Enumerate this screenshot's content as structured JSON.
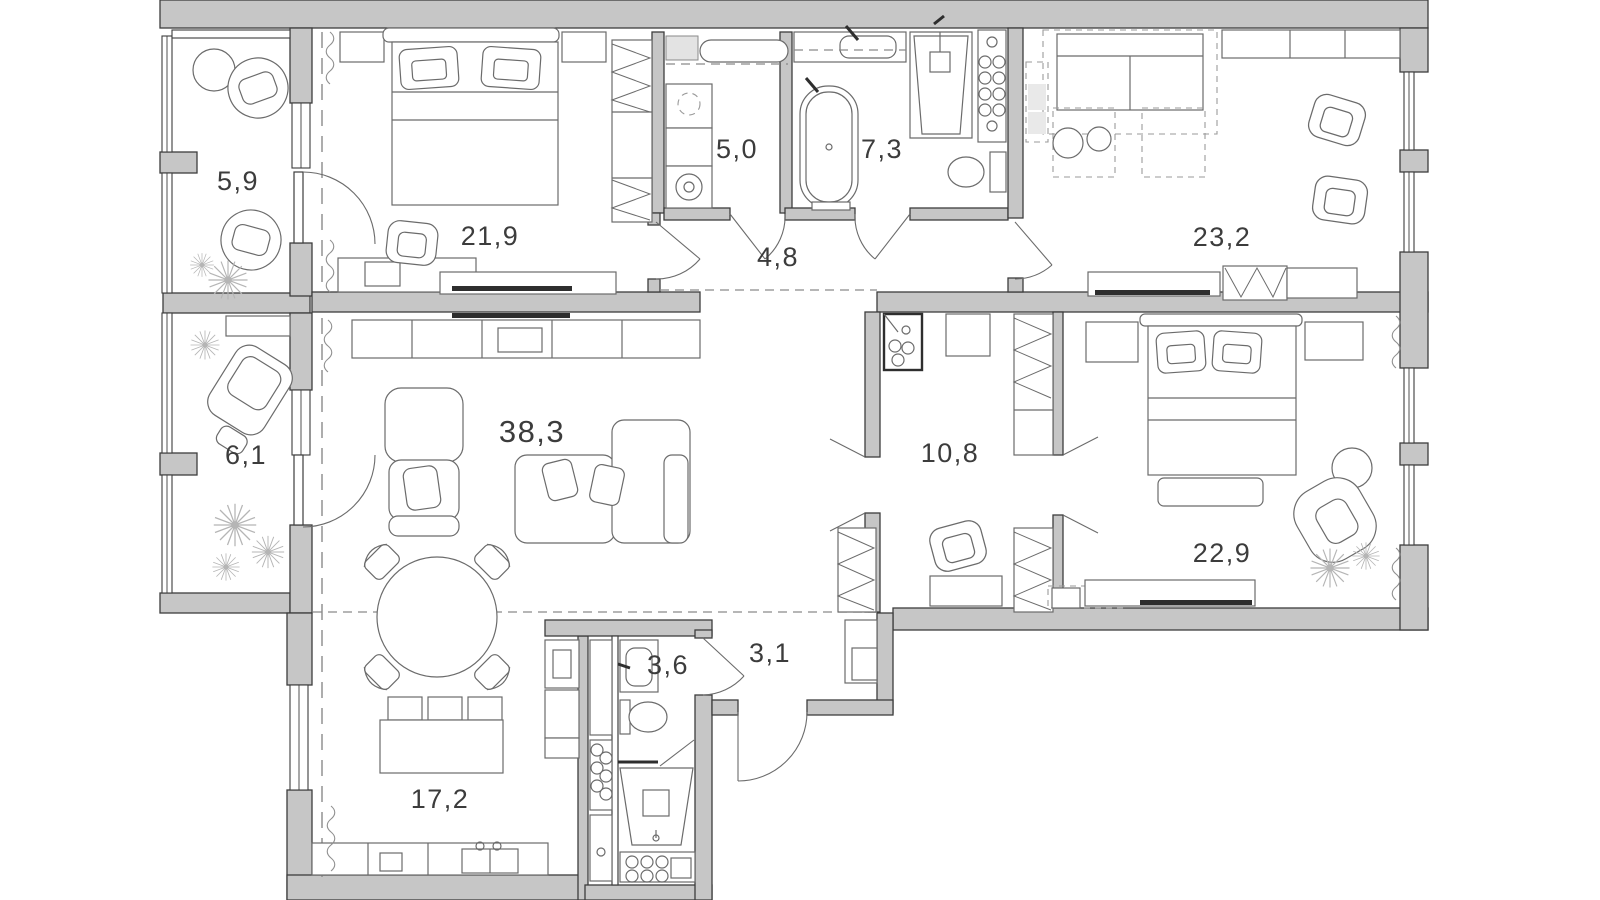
{
  "plan": {
    "type": "apartment-floor-plan",
    "rooms": [
      {
        "id": "balcony-top",
        "label": "5,9"
      },
      {
        "id": "bedroom-main",
        "label": "21,9"
      },
      {
        "id": "laundry",
        "label": "5,0"
      },
      {
        "id": "bathroom-main",
        "label": "7,3"
      },
      {
        "id": "corridor",
        "label": "4,8"
      },
      {
        "id": "lounge",
        "label": "23,2"
      },
      {
        "id": "balcony-bottom",
        "label": "6,1"
      },
      {
        "id": "living-room",
        "label": "38,3"
      },
      {
        "id": "hall",
        "label": "10,8"
      },
      {
        "id": "bedroom-second",
        "label": "22,9"
      },
      {
        "id": "bathroom-small",
        "label": "3,6"
      },
      {
        "id": "entry",
        "label": "3,1"
      },
      {
        "id": "kitchen",
        "label": "17,2"
      }
    ],
    "colors": {
      "wall_fill": "#c6c6c6",
      "wall_stroke": "#3d3d3d",
      "furniture_stroke": "#6b6b6b",
      "detail_dark": "#2e2e2e",
      "dashed_line": "#8a8a8a",
      "plant": "#b5b5b5",
      "label_text": "#3c3c3c",
      "background": "#ffffff"
    }
  }
}
